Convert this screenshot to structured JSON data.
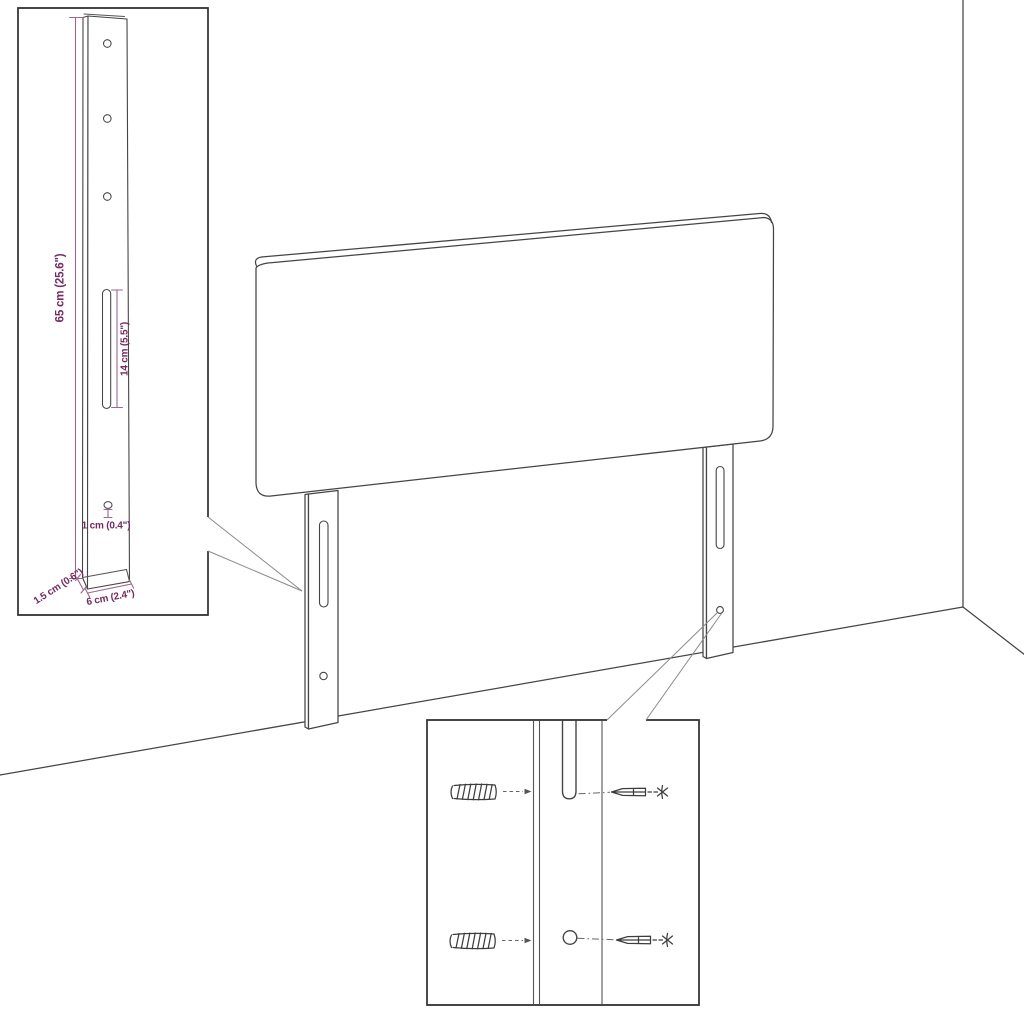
{
  "page": {
    "background": "#ffffff",
    "title": "Headboard dimension diagram"
  },
  "diagram": {
    "type": "product-dimension-line-drawing",
    "subject": "upholstered headboard with two wall-mount legs shown in a room corner",
    "insets": {
      "leg_detail": "magnified mounting leg with holes and slot",
      "mounting_detail": "magnified slot and hole with screws and wall plugs"
    },
    "dimensions": {
      "leg_height": "65 cm (25.6\")",
      "slot_length": "14 cm (5.5\")",
      "hole_size": "1 cm (0.4\")",
      "leg_thickness": "1.5 cm (0.6\")",
      "leg_width": "6 cm (2.4\")"
    },
    "colors": {
      "line_art": "#454545",
      "dimension_text": "#772a60",
      "dimension_lines": "#9a6890"
    },
    "icons": {
      "wall_plug": "wall-plug-icon",
      "screw": "screw-icon"
    }
  }
}
